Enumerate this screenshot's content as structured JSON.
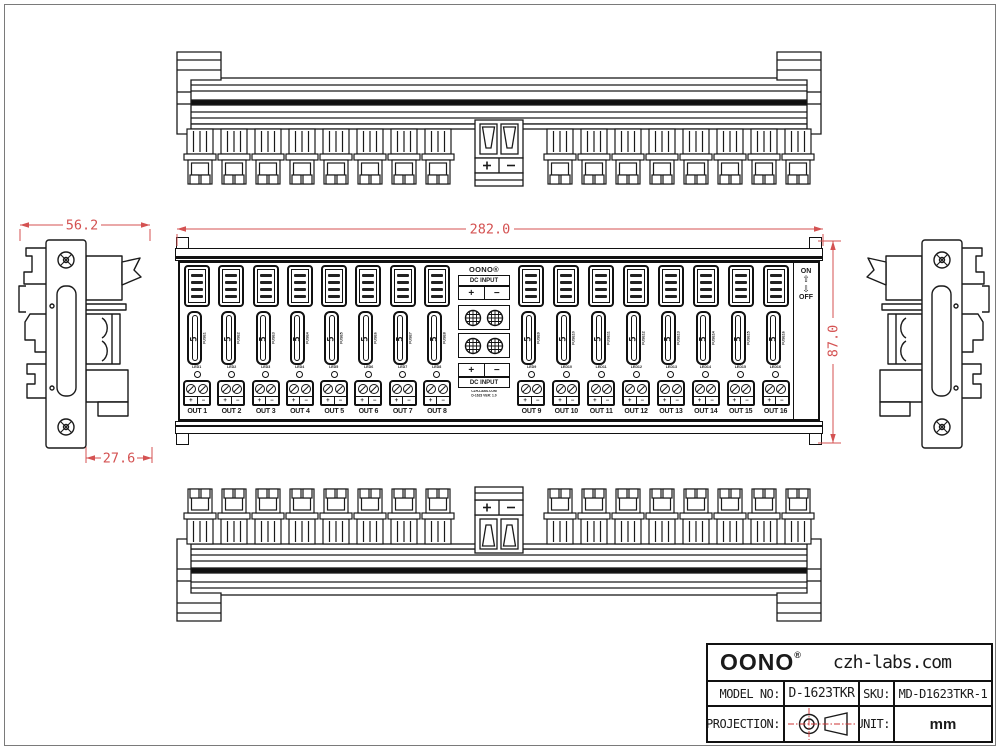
{
  "drawing": {
    "line_color": "#1a1a1a",
    "dimension_color": "#d45252",
    "background": "#ffffff"
  },
  "dimensions": {
    "overall_width": "282.0",
    "overall_height": "87.0",
    "side_width": "56.2",
    "clip_depth": "27.6"
  },
  "front_view": {
    "brand": "OONO®",
    "fuse_value": "5",
    "dc_input_label": "DC INPUT",
    "plus": "+",
    "minus": "−",
    "screw_plus": "+",
    "screw_minus": "−",
    "note_line1": "CZH-LABS.COM",
    "note_line2": "D-1623 VER: 1.0",
    "switch": {
      "on": "ON",
      "off": "OFF",
      "up_arrow": "⇧",
      "down_arrow": "⇩"
    },
    "channels": [
      {
        "out": "OUT 1",
        "fuse": "FUSE1",
        "led": "LED1"
      },
      {
        "out": "OUT 2",
        "fuse": "FUSE2",
        "led": "LED2"
      },
      {
        "out": "OUT 3",
        "fuse": "FUSE3",
        "led": "LED3"
      },
      {
        "out": "OUT 4",
        "fuse": "FUSE4",
        "led": "LED4"
      },
      {
        "out": "OUT 5",
        "fuse": "FUSE5",
        "led": "LED5"
      },
      {
        "out": "OUT 6",
        "fuse": "FUSE6",
        "led": "LED6"
      },
      {
        "out": "OUT 7",
        "fuse": "FUSE7",
        "led": "LED7"
      },
      {
        "out": "OUT 8",
        "fuse": "FUSE8",
        "led": "LED8"
      },
      {
        "out": "OUT 9",
        "fuse": "FUSE9",
        "led": "LED9"
      },
      {
        "out": "OUT 10",
        "fuse": "FUSE10",
        "led": "LED10"
      },
      {
        "out": "OUT 11",
        "fuse": "FUSE11",
        "led": "LED11"
      },
      {
        "out": "OUT 12",
        "fuse": "FUSE12",
        "led": "LED12"
      },
      {
        "out": "OUT 13",
        "fuse": "FUSE13",
        "led": "LED13"
      },
      {
        "out": "OUT 14",
        "fuse": "FUSE14",
        "led": "LED14"
      },
      {
        "out": "OUT 15",
        "fuse": "FUSE15",
        "led": "LED15"
      },
      {
        "out": "OUT 16",
        "fuse": "FUSE16",
        "led": "LED16"
      }
    ]
  },
  "title_block": {
    "brand": "OONO",
    "registered": "®",
    "website": "czh-labs.com",
    "model_label": "MODEL NO:",
    "model_value": "D-1623TKR",
    "sku_label": "SKU:",
    "sku_value": "MD-D1623TKR-1",
    "projection_label": "PROJECTION:",
    "unit_label": "UNIT:",
    "unit_value": "mm"
  }
}
